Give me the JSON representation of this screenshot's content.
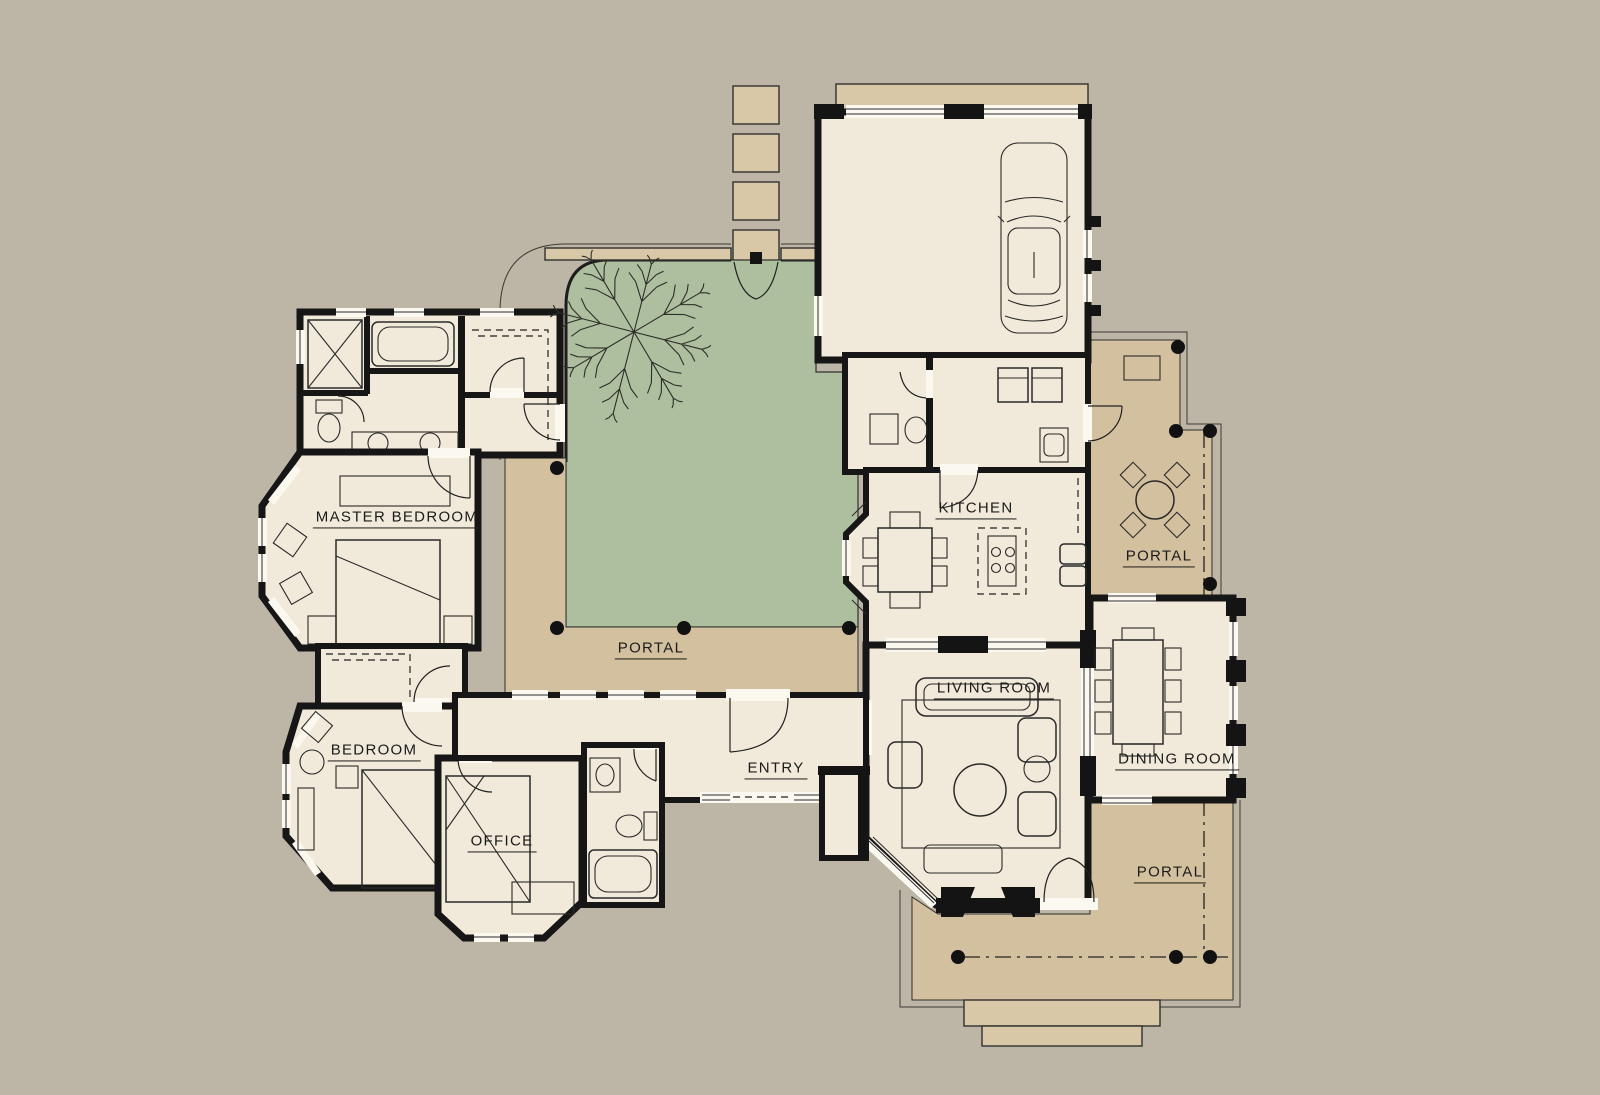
{
  "plan": {
    "type": "residential floor plan",
    "colors": {
      "background": "#bdb5a6",
      "room_floor": "#f1e9d9",
      "portal_floor": "#d3c09f",
      "courtyard_green": "#adbf9f",
      "paver_tan": "#d9c8a8",
      "wall_black": "#161616"
    },
    "labels": [
      {
        "id": "master-bedroom",
        "text": "MASTER BEDROOM",
        "x": 397,
        "y": 521
      },
      {
        "id": "bedroom",
        "text": "BEDROOM",
        "x": 374,
        "y": 754
      },
      {
        "id": "office",
        "text": "OFFICE",
        "x": 502,
        "y": 845
      },
      {
        "id": "entry",
        "text": "ENTRY",
        "x": 776,
        "y": 772
      },
      {
        "id": "kitchen",
        "text": "KITCHEN",
        "x": 976,
        "y": 512
      },
      {
        "id": "living-room",
        "text": "LIVING ROOM",
        "x": 994,
        "y": 692
      },
      {
        "id": "dining-room",
        "text": "DINING ROOM",
        "x": 1177,
        "y": 763
      },
      {
        "id": "portal-courtyard",
        "text": "PORTAL",
        "x": 651,
        "y": 652
      },
      {
        "id": "portal-east",
        "text": "PORTAL",
        "x": 1159,
        "y": 560
      },
      {
        "id": "portal-south",
        "text": "PORTAL",
        "x": 1170,
        "y": 876
      }
    ],
    "features": {
      "walkway_paver_count": 11,
      "car_in_garage": true,
      "courtyard_tree": true
    }
  }
}
